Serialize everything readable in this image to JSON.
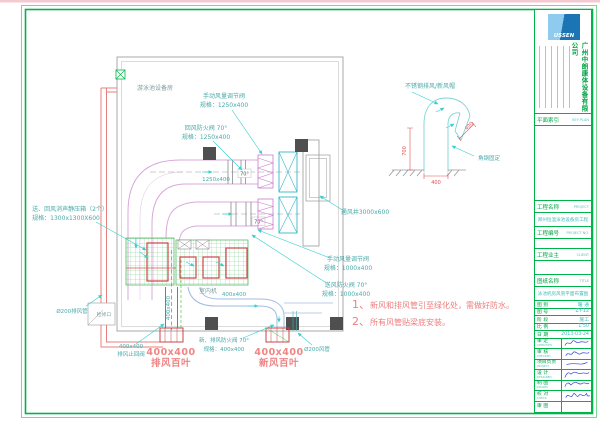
{
  "sheet": {
    "room_label": "游泳池设备房",
    "annotations": {
      "manual_damper1_l1": "手动风量调节阀",
      "manual_damper1_l2": "规格：1250x400",
      "return_fire_damper_l1": "回风防火阀 70°",
      "return_fire_damper_l2": "规格：1250x400",
      "duct_size_main": "1250x400",
      "deg70_a": "70°",
      "deg70_b": "70°",
      "vent_shaft": "通风井3000x600",
      "manual_damper2_l1": "手动风量调节阀",
      "manual_damper2_l2": "规格：1000x400",
      "supply_fire_damper_l1": "送风防火阀 70°",
      "supply_fire_damper_l2": "规格：1000x400",
      "plenum_l1": "送、回风消声静压箱（2个）",
      "plenum_l2": "规格：1300x1300X600",
      "pipe_left": "Ø200排风管",
      "access_panel": "检修口",
      "check_valve_l1": "400x400",
      "check_valve_l2": "排风止回阀",
      "exhaust_louver_size": "400x400",
      "exhaust_louver_name": "排风百叶",
      "bottom_fire_damper_l1": "新、排风防火阀 70°",
      "bottom_fire_damper_l2": "规格：400x400",
      "fresh_louver_size": "400x400",
      "fresh_louver_name": "新风百叶",
      "pipe_right": "Ø200风管",
      "duct_400_h": "400x400",
      "duct_400_v": "400x400",
      "indoor_unit": "室内机"
    },
    "detail": {
      "cap_label": "不锈钢排风/新风帽",
      "dim_opening": "400",
      "dim_height": "700",
      "dim_width": "400",
      "fix_label": "角钢固定"
    },
    "notes": {
      "n1_num": "1、",
      "n1": "新风和排风管引至绿化处，需做好防水。",
      "n2_num": "2、",
      "n2": "所有风管贴梁底安装。"
    }
  },
  "title_block": {
    "logo_text": "USSEN",
    "company": "广州中朗康体设备有限公司",
    "key_plan": {
      "label": "平面索引",
      "en": "KEY PLAN"
    },
    "fields": {
      "project_label": "工程名称",
      "project_en": "PROJECT",
      "project_value": "郑州恒温泳池设备房工程",
      "number_label": "工程编号",
      "number_en": "PROJECT NO.",
      "client_label": "工程业主",
      "client_en": "CLIENT",
      "title_label": "图纸名称",
      "title_en": "TITLE",
      "title_value": "泳池机房风管平面布置图"
    },
    "meta": [
      {
        "label": "图 别",
        "value": "暖 通"
      },
      {
        "label": "图 号",
        "value": "ZY-12"
      },
      {
        "label": "阶 段",
        "value": "施工"
      },
      {
        "label": "比 例",
        "value": "1:50"
      },
      {
        "label": "日 期",
        "value": "2013-03-24"
      }
    ],
    "signs": [
      {
        "label": "审 定",
        "en": "APPROVED"
      },
      {
        "label": "审 核",
        "en": "CHECKED"
      },
      {
        "label": "项目负责",
        "en": "PROJECT"
      },
      {
        "label": "设 计",
        "en": "DESIGNED"
      },
      {
        "label": "制 图",
        "en": "DRAWN"
      },
      {
        "label": "校 对",
        "en": "CHECK"
      },
      {
        "label": "审 图",
        "en": ""
      }
    ]
  },
  "colors": {
    "frame_green": "#00b44b",
    "annotation_teal": "#4aa9a9",
    "cyan_arrow": "#35cfcf",
    "duct_pink": "#d9a8da",
    "red": "#e05252",
    "louver_red": "#ef8585",
    "ink_blue": "#2b3fd6",
    "logo_blue": "#1b74b4"
  }
}
